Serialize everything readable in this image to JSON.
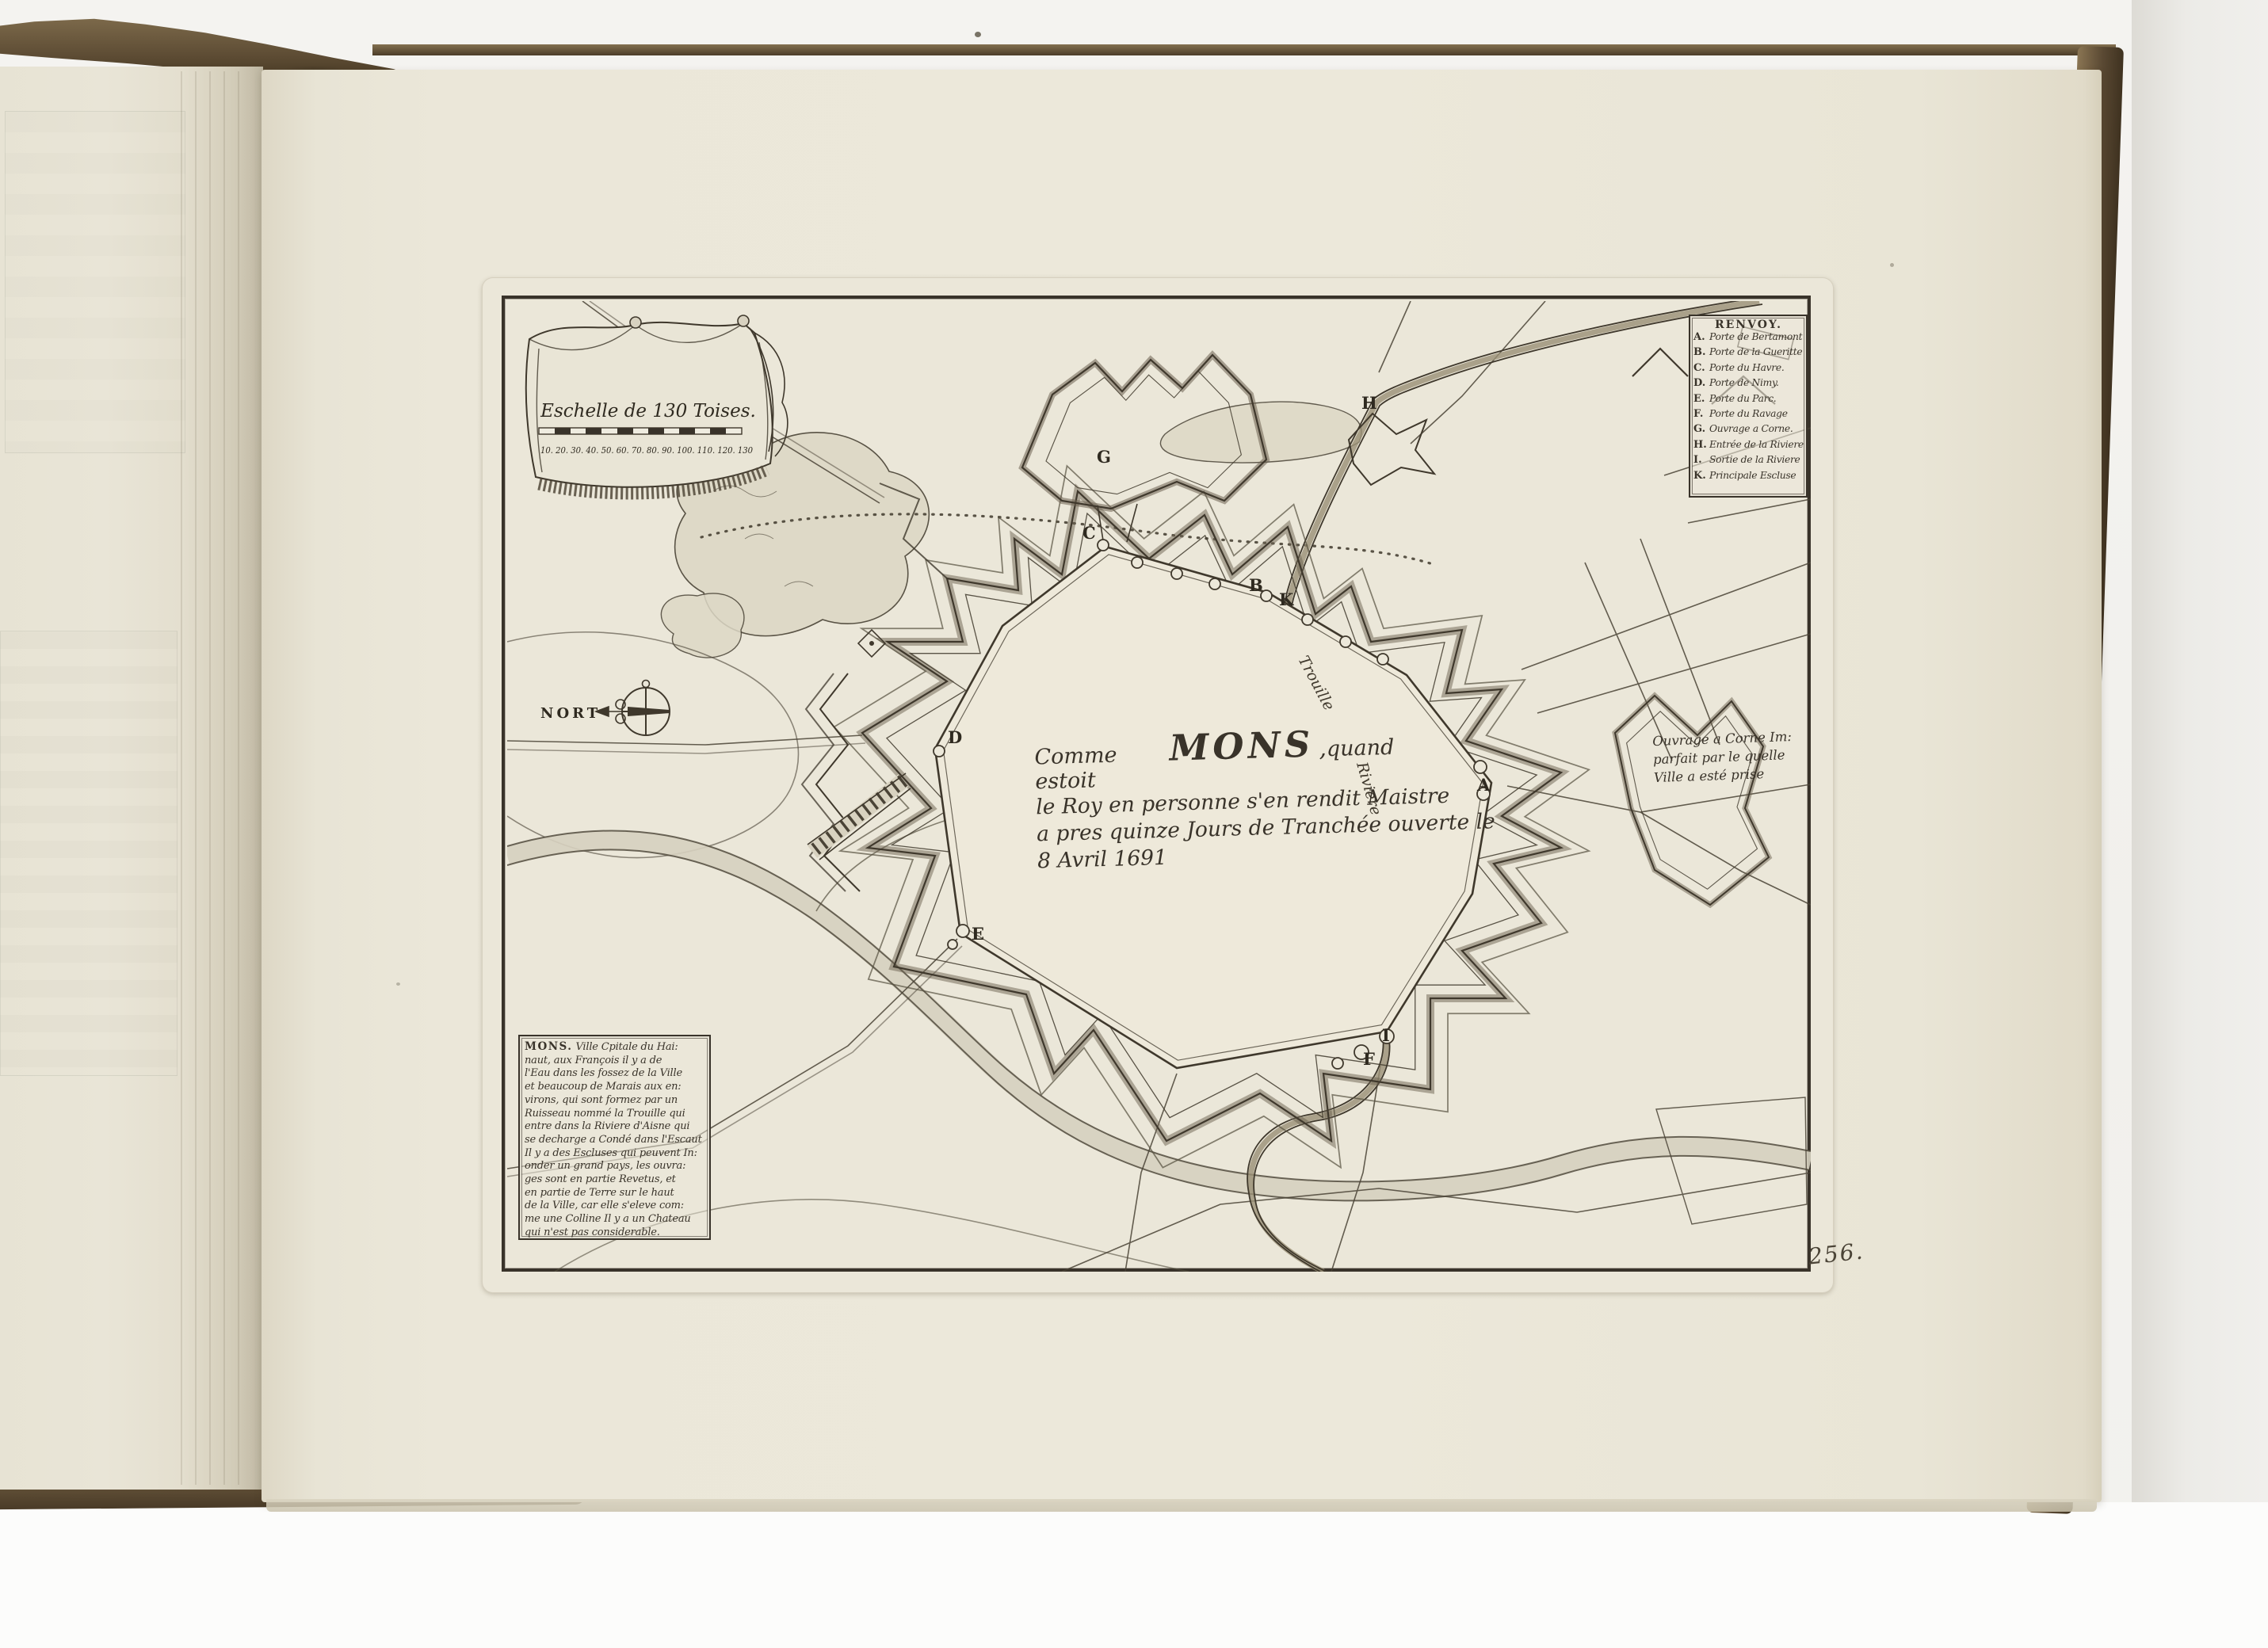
{
  "book": {
    "folio_number": "256."
  },
  "plate": {
    "compass_label": "NORT",
    "scale": {
      "title": "Eschelle de 130 Toises.",
      "ticks": "10. 20. 30. 40. 50. 60. 70. 80. 90. 100. 110. 120. 130"
    },
    "legend": {
      "title": "RENVOY.",
      "entries": [
        {
          "key": "A.",
          "label": "Porte de Bertamont"
        },
        {
          "key": "B.",
          "label": "Porte de la Gueritte"
        },
        {
          "key": "C.",
          "label": "Porte du Havre."
        },
        {
          "key": "D.",
          "label": "Porte de Nimy."
        },
        {
          "key": "E.",
          "label": "Porte du Parc."
        },
        {
          "key": "F.",
          "label": "Porte du Ravage"
        },
        {
          "key": "G.",
          "label": "Ouvrage a Corne."
        },
        {
          "key": "H.",
          "label": "Entrée de la Riviere"
        },
        {
          "key": "I.",
          "label": "Sortie de la Riviere"
        },
        {
          "key": "K.",
          "label": "Principale Escluse"
        }
      ]
    },
    "title_block": {
      "prefix": "Comme estoit",
      "city": "MONS",
      "comma": ",",
      "tail": "quand",
      "line2": "le Roy en personne s'en rendit Maistre",
      "line3": "a pres quinze Jours de Tranchée ouverte le",
      "line4": "8 Avril 1691"
    },
    "hornwork_note": {
      "line1": "Ouvrage a Corne Im:",
      "line2": "parfait par le quelle",
      "line3": "Ville a esté prise"
    },
    "river": {
      "label1": "Trouille",
      "label2": "Riviere"
    },
    "markers": [
      "A",
      "B",
      "C",
      "D",
      "E",
      "F",
      "G",
      "H",
      "I",
      "K"
    ],
    "description": {
      "lead": "MONS.",
      "lines": [
        "Ville Cpitale du Hai:",
        "naut, aux François il y a de",
        "l'Eau dans les fossez de la Ville",
        "et beaucoup de Marais aux en:",
        "virons, qui sont formez par un",
        "Ruisseau nommé la Trouille qui",
        "entre dans la Riviere d'Aisne qui",
        "se decharge a Condé dans l'Escaut",
        "Il y a des Escluses qui peuvent In:",
        "onder un grand pays, les ouvra:",
        "ges sont en partie Revetus, et",
        "en partie de Terre sur le haut",
        "de la Ville, car elle s'eleve com:",
        "me une Colline Il y a un Chateau",
        "qui n'est pas considerable."
      ]
    }
  },
  "colors": {
    "paper": "#ece8da",
    "ink": "#3f382c",
    "leather": "#6d5a41",
    "background": "#f2f1ed"
  }
}
